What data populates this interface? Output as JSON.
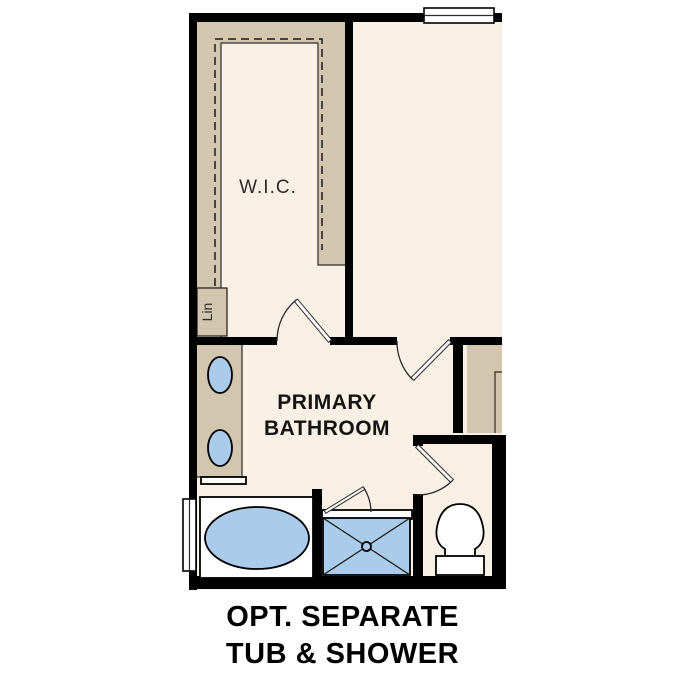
{
  "caption": {
    "line1": "OPT. SEPARATE",
    "line2": "TUB & SHOWER"
  },
  "labels": {
    "walk_in_closet": "W.I.C.",
    "linen": "Lin",
    "bathroom_line1": "PRIMARY",
    "bathroom_line2": "BATHROOM"
  },
  "colors": {
    "background": "#ffffff",
    "wall": "#000000",
    "floor": "#f8f0e4",
    "casework": "#d2c6ae",
    "fixture": "#aacbe9",
    "fixture_white": "#ffffff",
    "line": "#2b2b2b",
    "label_text": "#2b2b2b",
    "caption_text": "#000000"
  }
}
